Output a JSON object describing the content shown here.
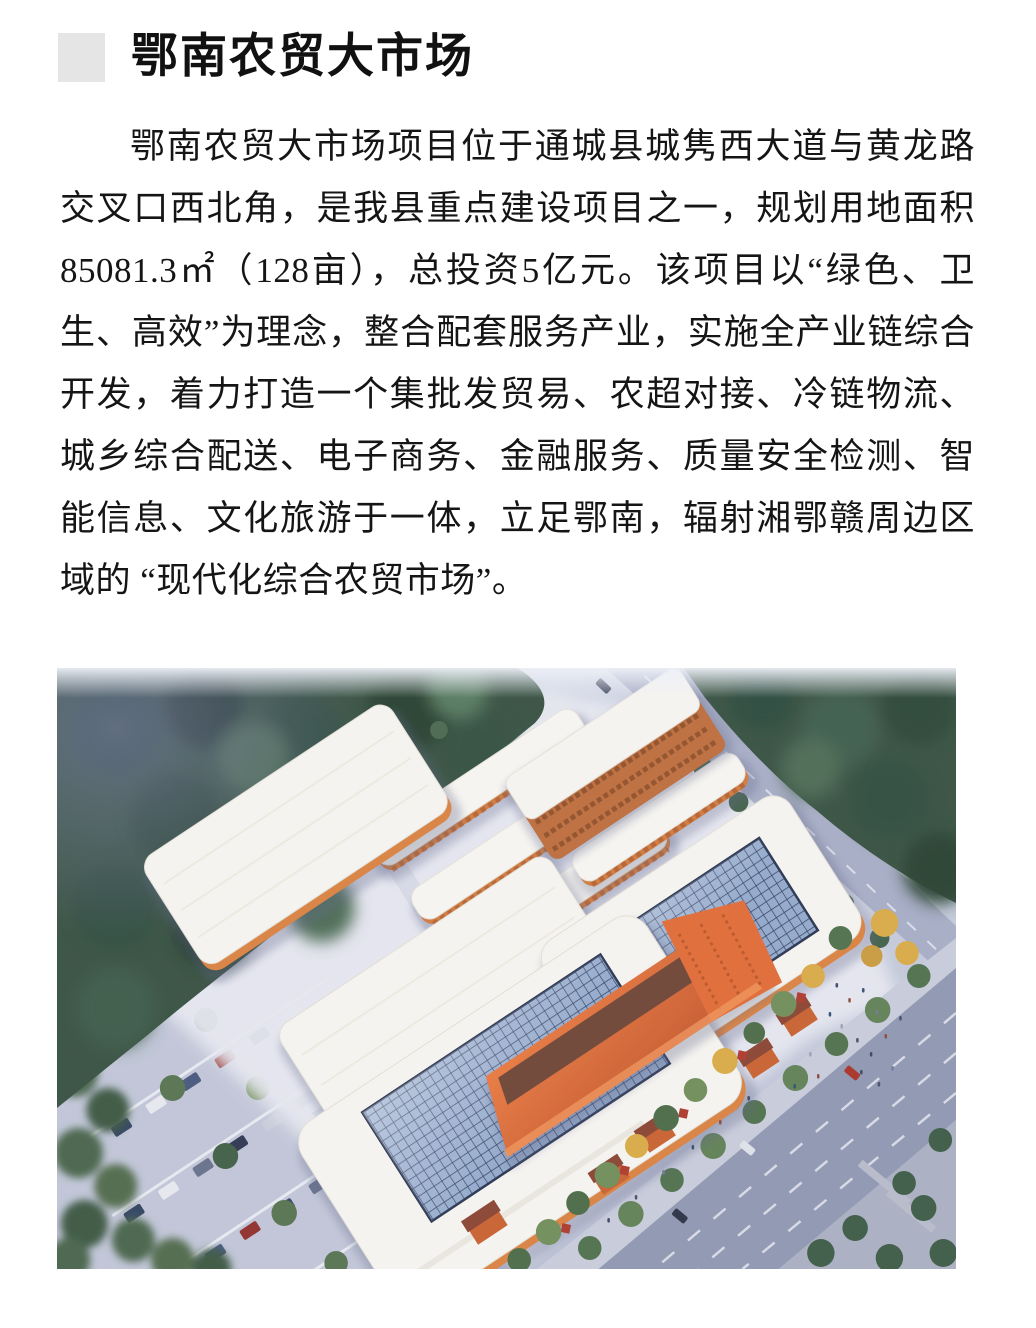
{
  "header": {
    "marker_color": "#e5e5e5",
    "title": "鄂南农贸大市场"
  },
  "article": {
    "paragraph": "鄂南农贸大市场项目位于通城县城隽西大道与黄龙路交叉口西北角，是我县重点建设项目之一，规划用地面积85081.3㎡（128亩），总投资5亿元。该项目以“绿色、卫生、高效”为理念，整合配套服务产业，实施全产业链综合开发，着力打造一个集批发贸易、农超对接、冷链物流、城乡综合配送、电子商务、金融服务、质量安全检测、智能信息、文化旅游于一体，立足鄂南，辐射湘鄂赣周边区域的 “现代化综合农贸市场”。"
  },
  "image": {
    "palette": {
      "roof_white": "#f6f4ef",
      "wall_orange": "#d9813f",
      "accent_orange": "#e06a33",
      "roof_brown": "#6e4434",
      "skylight_blue": "#93a9cb",
      "skylight_grid": "#2e3c5c",
      "forest_green": "#36503f",
      "tree_green": "#55724d",
      "tree_yellow": "#d9a944",
      "road_gray": "#8f96b0",
      "sidewalk_gray": "#c8ccda",
      "parking_gray": "#c0c5d6",
      "plaza_light": "#e6e7ef",
      "planter_red": "#ad392b"
    }
  }
}
